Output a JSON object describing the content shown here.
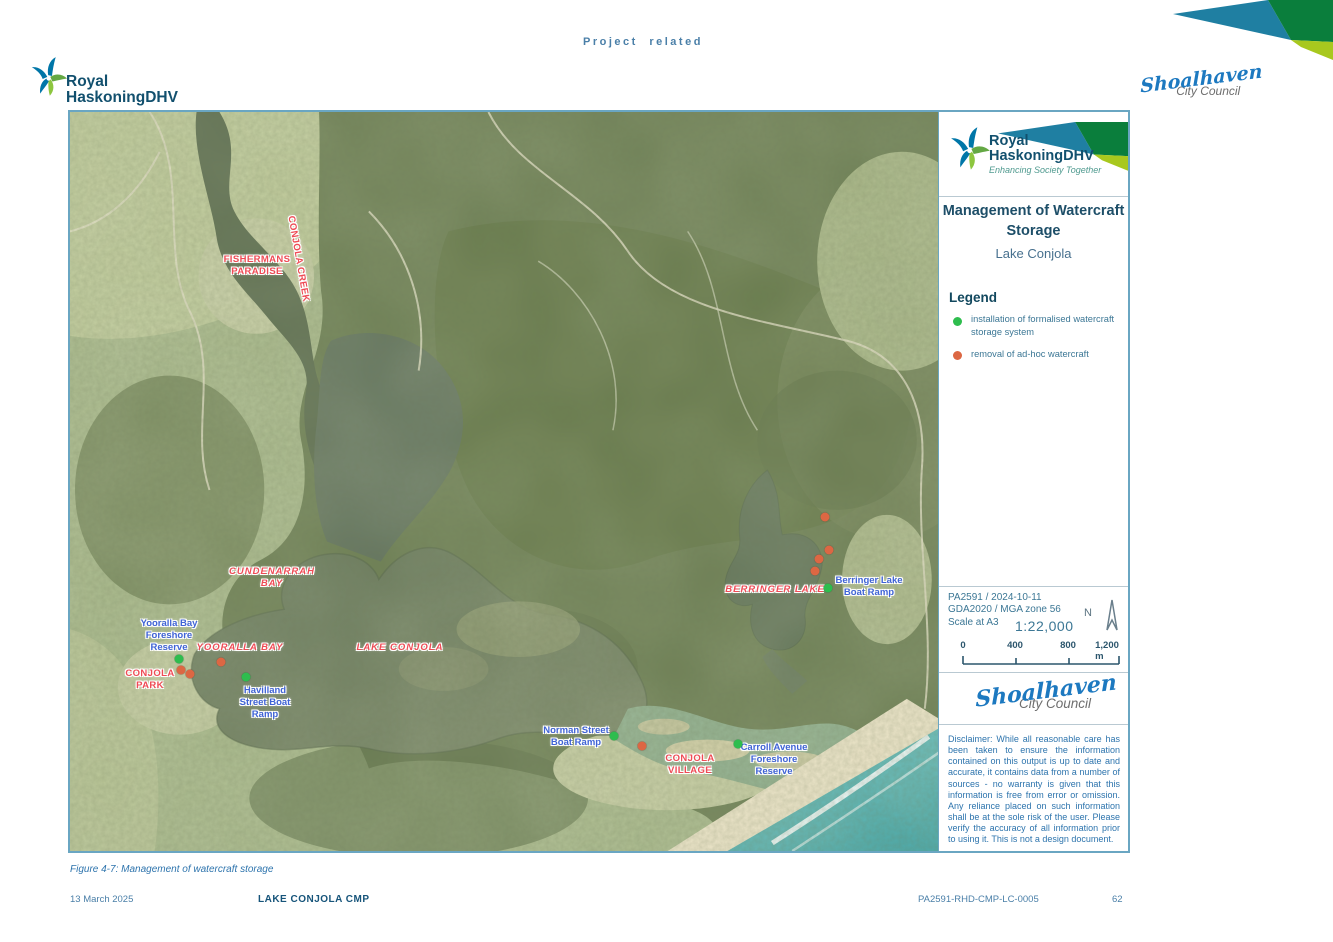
{
  "page": {
    "header": "Project related",
    "caption": "Figure 4-7: Management of watercraft storage",
    "footer": {
      "date": "13 March 2025",
      "doc_title": "LAKE CONJOLA CMP",
      "doc_number": "PA2591-RHD-CMP-LC-0005",
      "page_number": "62"
    }
  },
  "branding": {
    "rhdhv_line1": "Royal",
    "rhdhv_line2": "HaskoningDHV",
    "rhdhv_tagline": "Enhancing Society Together",
    "shoalhaven_script": "Shoalhaven",
    "shoalhaven_sub": "City Council"
  },
  "panel": {
    "title_line1": "Management of Watercraft",
    "title_line2": "Storage",
    "subtitle": "Lake Conjola",
    "legend": {
      "heading": "Legend",
      "item_green": "installation of formalised watercraft\nstorage system",
      "item_orange": "removal of ad-hoc watercraft"
    },
    "meta": {
      "project_line": "PA2591 / 2024-10-11",
      "datum_line": "GDA2020 / MGA zone 56",
      "scale_label": "Scale at A3",
      "scale_value": "1:22,000",
      "north_label": "N",
      "scalebar_ticks": [
        "0",
        "400",
        "800",
        "1,200 m"
      ]
    },
    "disclaimer": "Disclaimer: While all reasonable care has been taken to ensure the information contained on this output is up to date and accurate, it contains data from a number of sources - no warranty is given that this information is free from error or omission. Any reliance placed on such information shall be at the sole risk of the user. Please verify the accuracy of all information prior to using it. This is not a design document."
  },
  "map": {
    "red_labels": [
      {
        "text": "FISHERMANS\nPARADISE",
        "x": 187,
        "y": 154,
        "italic": false
      },
      {
        "text": "CONJOLA CREEK",
        "x": 228,
        "y": 147,
        "italic": false,
        "rot": 80
      },
      {
        "text": "CUNDENARRAH\nBAY",
        "x": 202,
        "y": 466,
        "italic": true
      },
      {
        "text": "YOORALLA BAY",
        "x": 170,
        "y": 536,
        "italic": true
      },
      {
        "text": "LAKE CONJOLA",
        "x": 330,
        "y": 536,
        "italic": true
      },
      {
        "text": "BERRINGER LAKE",
        "x": 705,
        "y": 478,
        "italic": true
      },
      {
        "text": "CONJOLA\nPARK",
        "x": 80,
        "y": 568,
        "italic": false
      },
      {
        "text": "CONJOLA\nVILLAGE",
        "x": 620,
        "y": 653,
        "italic": false
      }
    ],
    "blue_labels": [
      {
        "text": "Yooralla Bay\nForeshore\nReserve",
        "x": 99,
        "y": 524
      },
      {
        "text": "Havilland\nStreet Boat\nRamp",
        "x": 195,
        "y": 591
      },
      {
        "text": "Norman Street\nBoat Ramp",
        "x": 506,
        "y": 625
      },
      {
        "text": "Carroll Avenue\nForeshore\nReserve",
        "x": 704,
        "y": 648
      },
      {
        "text": "Berringer Lake\nBoat Ramp",
        "x": 799,
        "y": 475
      }
    ],
    "markers": [
      {
        "type": "green",
        "x": 109,
        "y": 547
      },
      {
        "type": "green",
        "x": 176,
        "y": 565
      },
      {
        "type": "green",
        "x": 544,
        "y": 624
      },
      {
        "type": "green",
        "x": 668,
        "y": 632
      },
      {
        "type": "green",
        "x": 758,
        "y": 476
      },
      {
        "type": "orange",
        "x": 111,
        "y": 558
      },
      {
        "type": "orange",
        "x": 120,
        "y": 562
      },
      {
        "type": "orange",
        "x": 151,
        "y": 550
      },
      {
        "type": "orange",
        "x": 572,
        "y": 634
      },
      {
        "type": "orange",
        "x": 755,
        "y": 405
      },
      {
        "type": "orange",
        "x": 759,
        "y": 438
      },
      {
        "type": "orange",
        "x": 749,
        "y": 447
      },
      {
        "type": "orange",
        "x": 745,
        "y": 459
      }
    ]
  },
  "colors": {
    "marker_green": "#2ebd4e",
    "marker_orange": "#dc6743",
    "label_red": "#ef4b55",
    "label_blue": "#3f63d6",
    "ribbon_teal": "#1f7fa2",
    "ribbon_dark_green": "#0a7e3c",
    "ribbon_light_green": "#a8c81e",
    "map_border": "#6aa6c2"
  }
}
